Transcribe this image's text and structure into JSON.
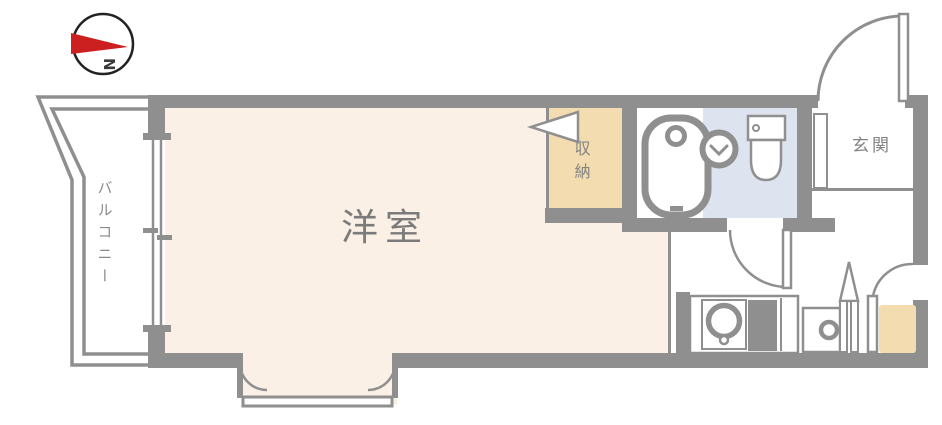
{
  "plan": {
    "compass": {
      "label": "N",
      "needle_direction": "right"
    },
    "rooms": {
      "balcony": "バルコニー",
      "western_room": "洋室",
      "storage": "収納",
      "entrance": "玄関"
    },
    "colors": {
      "wall": "#8f8f8f",
      "room_floor": "#faf0e6",
      "storage_floor": "#f3ddb0",
      "bathroom_floor": "#dde4f0",
      "refrigerator_space": "#f3ddb0",
      "compass_needle": "#cc1f1f",
      "label_text": "#7f7f7f",
      "background": "#ffffff"
    },
    "fixtures": [
      "bathtub",
      "washbasin",
      "toilet",
      "kitchen-sink",
      "stove",
      "washing-machine",
      "refrigerator-space",
      "shoe-cabinet",
      "entrance-door",
      "bathroom-door",
      "folding-closet-door",
      "sliding-window",
      "bay-window"
    ]
  }
}
